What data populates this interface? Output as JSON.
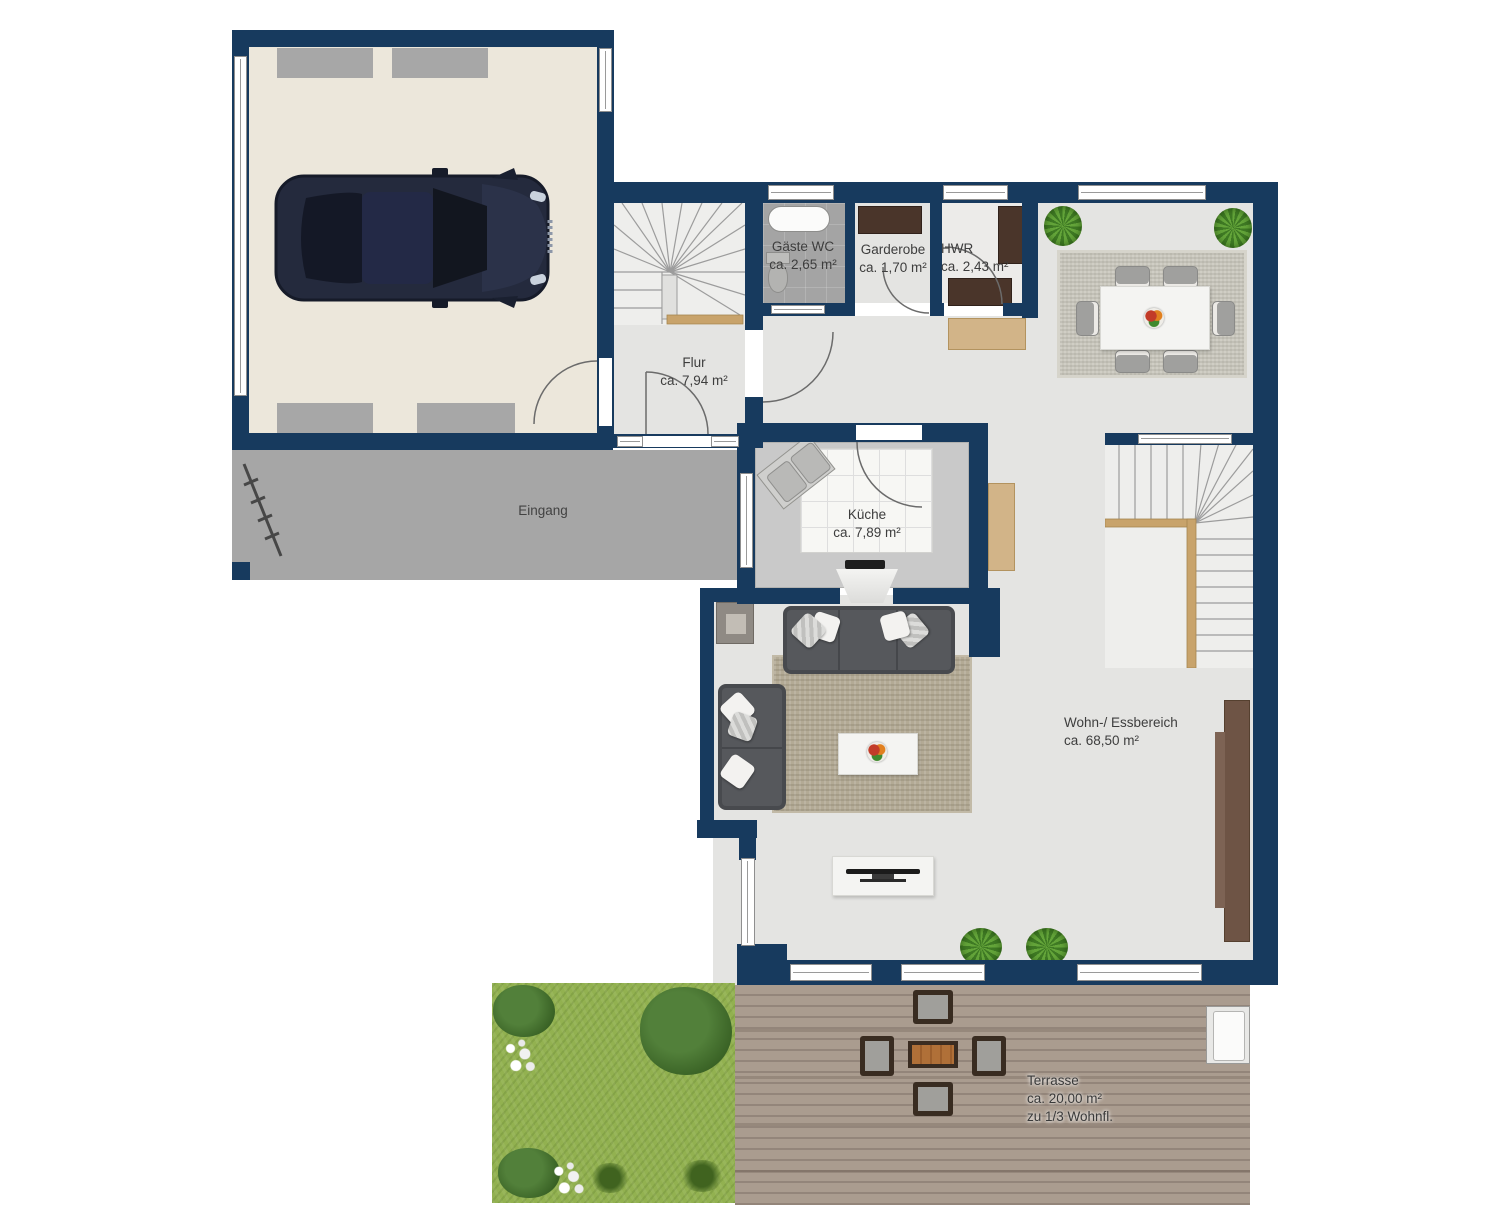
{
  "rooms": {
    "gaeste_wc": {
      "name": "Gäste WC",
      "area": "ca. 2,65 m²"
    },
    "garderobe": {
      "name": "Garderobe",
      "area": "ca. 1,70 m²"
    },
    "hwr": {
      "name": "HWR",
      "area": "ca. 2,43 m²"
    },
    "flur": {
      "name": "Flur",
      "area": "ca. 7,94 m²"
    },
    "kueche": {
      "name": "Küche",
      "area": "ca. 7,89 m²"
    },
    "wohn_essbereich": {
      "name": "Wohn-/ Essbereich",
      "area": "ca. 68,50 m²"
    },
    "eingang": {
      "name": "Eingang"
    },
    "terrasse": {
      "name": "Terrasse",
      "area": "ca. 20,00 m²",
      "note": "zu 1/3 Wohnfl."
    }
  },
  "colors": {
    "wall": "#173a5e",
    "garage_floor": "#ece7db",
    "interior_floor": "#e4e4e2",
    "entrance_path": "#a6a6a6",
    "terrace_wood": "#a3968a",
    "grass": "#92b150",
    "dark_furniture": "#4a352a",
    "tan_furniture": "#d2b488",
    "sofa": "#56585c",
    "car": "#242a3d"
  }
}
